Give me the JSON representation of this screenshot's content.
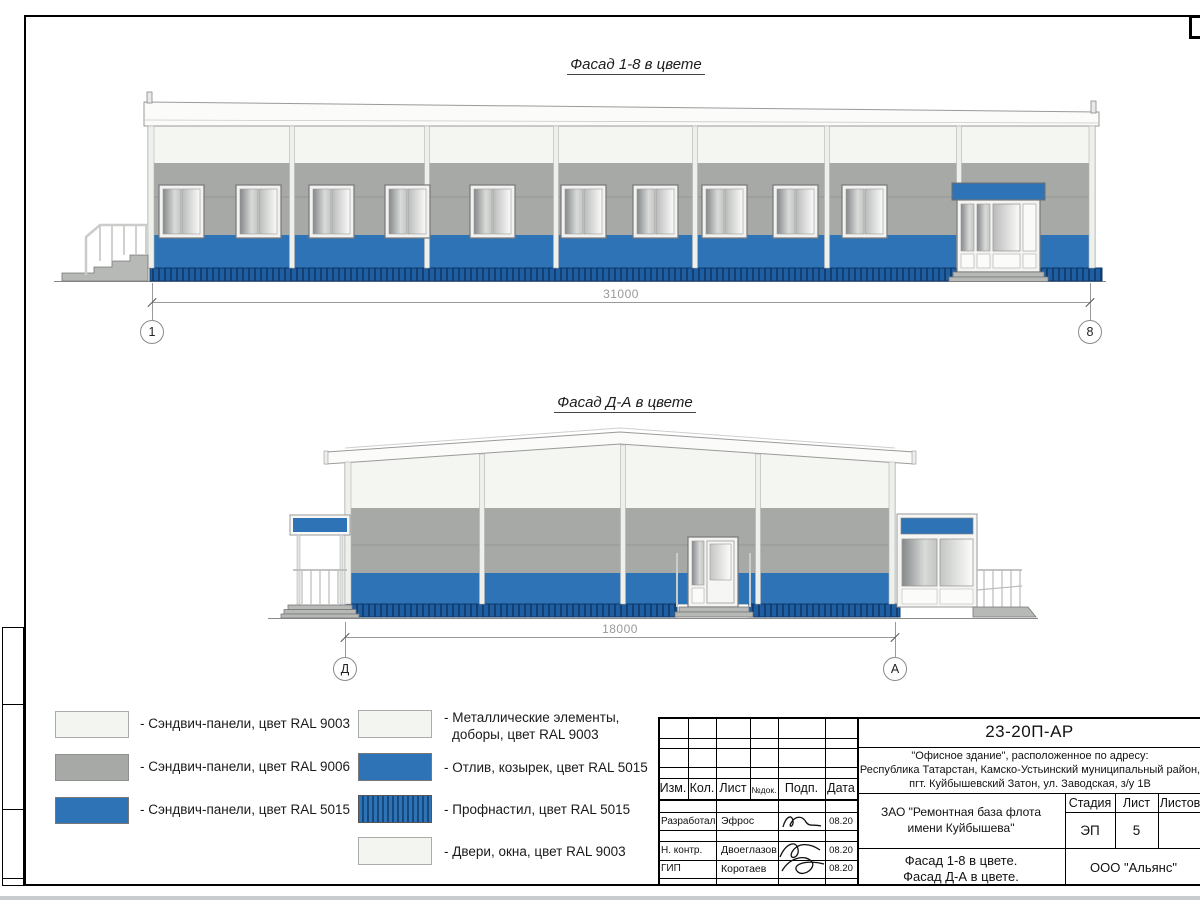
{
  "drawings": [
    {
      "title": "Фасад 1-8 в цвете",
      "dimension": "31000",
      "axis_left": "1",
      "axis_right": "8"
    },
    {
      "title": "Фасад Д-А в цвете",
      "dimension": "18000",
      "axis_left": "Д",
      "axis_right": "А"
    }
  ],
  "legend": {
    "left": [
      {
        "swatch": "ral9003",
        "label": "- Сэндвич-панели, цвет RAL 9003"
      },
      {
        "swatch": "ral9006",
        "label": "- Сэндвич-панели, цвет RAL 9006"
      },
      {
        "swatch": "ral5015",
        "label": "- Сэндвич-панели, цвет RAL 5015"
      }
    ],
    "right": [
      {
        "swatch": "ral9003",
        "label_line1": "- Металлические элементы,",
        "label_line2": "доборы, цвет RAL 9003"
      },
      {
        "swatch": "ral5015",
        "label": "- Отлив, козырек, цвет RAL 5015"
      },
      {
        "swatch": "ral5015_striped",
        "label": "- Профнастил, цвет RAL 5015"
      },
      {
        "swatch": "ral9003",
        "label": "- Двери, окна, цвет RAL 9003"
      }
    ]
  },
  "titleblock": {
    "code": "23-20П-АР",
    "address_line1": "\"Офисное здание\", расположенное по адресу:",
    "address_line2": "Республика Татарстан, Камско-Устьинский муниципальный район,",
    "address_line3": "пгт. Куйбышевский Затон, ул. Заводская, з/у 1В",
    "client_line1": "ЗАО \"Ремонтная база флота",
    "client_line2": "имени Куйбышева\"",
    "sheet_title_line1": "Фасад 1-8 в цвете.",
    "sheet_title_line2": "Фасад Д-А в цвете.",
    "company": "ООО \"Альянс\"",
    "col_izm": "Изм.",
    "col_kol": "Кол.",
    "col_list": "Лист",
    "col_ndoc": "№док.",
    "col_podp": "Подп.",
    "col_data": "Дата",
    "stage_header": "Стадия",
    "sheet_header": "Лист",
    "sheets_header": "Листов",
    "stage_value": "ЭП",
    "sheet_value": "5",
    "rows": [
      {
        "role": "Разработал",
        "name": "Эфрос",
        "date": "08.20"
      },
      {
        "role": "Н. контр.",
        "name": "Двоеглазов",
        "date": "08.20"
      },
      {
        "role": "ГИП",
        "name": "Коротаев",
        "date": "08.20"
      }
    ]
  },
  "colors": {
    "ral9003": "#f3f5f0",
    "ral9006": "#a7a9a6",
    "ral5015": "#2d73b5",
    "profnastil_dark": "#16497e"
  }
}
